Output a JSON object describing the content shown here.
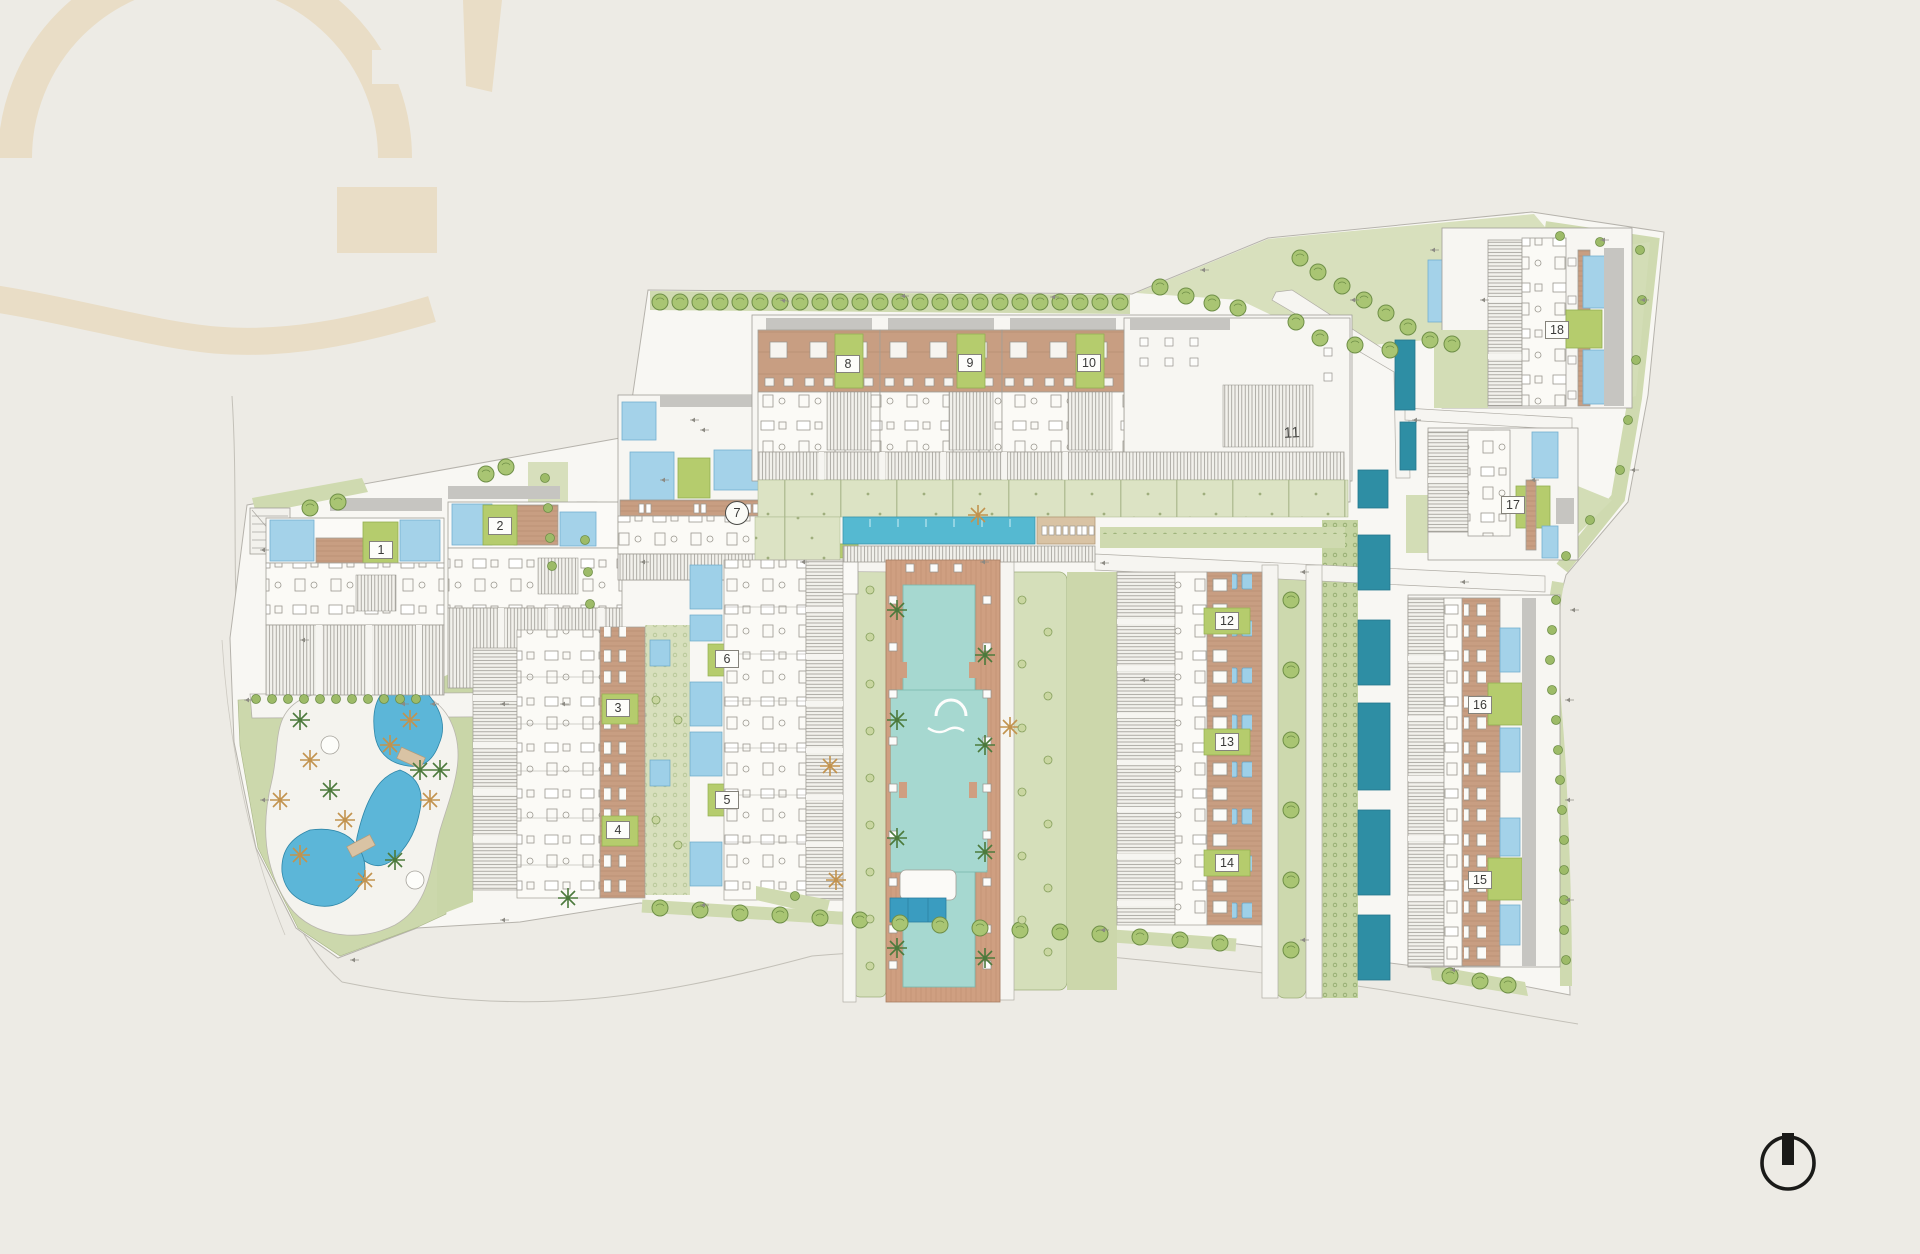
{
  "document": {
    "type": "architectural-master-site-plan",
    "paper_color": "#edebe5",
    "watermark_color": "#e9ddc6"
  },
  "compass": {
    "x": 1788,
    "y": 1163,
    "radius": 26,
    "color": "#1a1a18"
  },
  "palette": {
    "ground": "#f8f7f3",
    "lawn_light": "#dce3c4",
    "lawn": "#cfdab0",
    "lawn_dark": "#c5d4a2",
    "plate_green": "#b5cc6d",
    "tree_green": "#a9c573",
    "palm_green": "#4c7a3c",
    "palm_orange": "#c2934e",
    "roof_terracotta": "#c89e82",
    "deck_tan": "#d9c3a4",
    "pool_light_blue": "#a4d2e9",
    "pool_lagoon_blue": "#5cb6d8",
    "pool_lap_teal": "#55b9d1",
    "pool_courtyard_aqua": "#a6d8d0",
    "pool_dark_teal": "#2e8ea4",
    "roof_gray": "#c6c5c1",
    "line_gray": "#a19e97"
  },
  "features": [
    "lagoon-pool-park",
    "central-courtyard-pool",
    "lap-pool",
    "circular-pool",
    "private-plunge-pools",
    "perimeter-tree-rows",
    "north-compass",
    "brand-watermark"
  ],
  "buildings": [
    {
      "label": "1",
      "x": 381,
      "y": 550,
      "style": "plate"
    },
    {
      "label": "2",
      "x": 500,
      "y": 526,
      "style": "plate"
    },
    {
      "label": "3",
      "x": 618,
      "y": 708,
      "style": "plate"
    },
    {
      "label": "4",
      "x": 618,
      "y": 830,
      "style": "plate"
    },
    {
      "label": "5",
      "x": 727,
      "y": 800,
      "style": "plate"
    },
    {
      "label": "6",
      "x": 727,
      "y": 659,
      "style": "plate"
    },
    {
      "label": "7",
      "x": 737,
      "y": 513,
      "style": "circle"
    },
    {
      "label": "8",
      "x": 848,
      "y": 364,
      "style": "plate"
    },
    {
      "label": "9",
      "x": 970,
      "y": 363,
      "style": "plate"
    },
    {
      "label": "10",
      "x": 1089,
      "y": 363,
      "style": "plate"
    },
    {
      "label": "11",
      "x": 1292,
      "y": 433,
      "style": "plain"
    },
    {
      "label": "12",
      "x": 1227,
      "y": 621,
      "style": "plate"
    },
    {
      "label": "13",
      "x": 1227,
      "y": 742,
      "style": "plate"
    },
    {
      "label": "14",
      "x": 1227,
      "y": 863,
      "style": "plate"
    },
    {
      "label": "15",
      "x": 1480,
      "y": 880,
      "style": "plate"
    },
    {
      "label": "16",
      "x": 1480,
      "y": 705,
      "style": "plate"
    },
    {
      "label": "17",
      "x": 1513,
      "y": 505,
      "style": "plate"
    },
    {
      "label": "18",
      "x": 1557,
      "y": 330,
      "style": "plate"
    }
  ]
}
